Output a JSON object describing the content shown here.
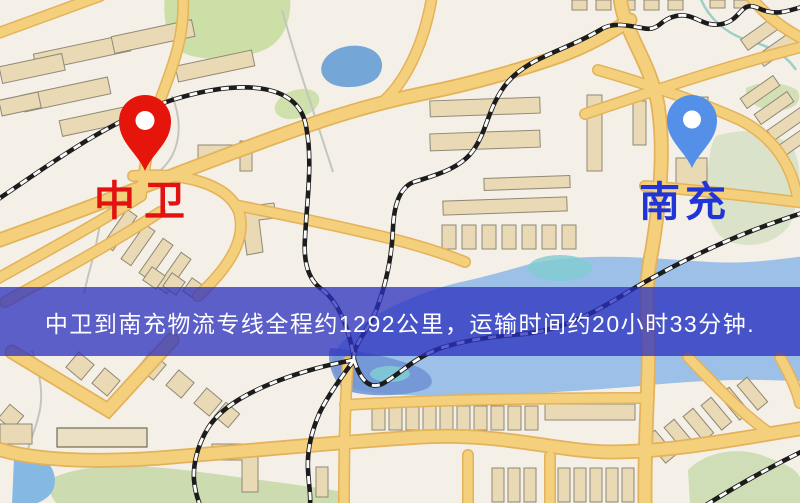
{
  "map": {
    "banner": {
      "text": "中卫到南充物流专线全程约1292公里，运输时间约20小时33分钟.",
      "background": "#2c30be",
      "text_color": "#ffffff"
    },
    "origin": {
      "name": "中卫",
      "label_color": "#e21212",
      "pin_color": "#e6150c",
      "pin_icon": "red-map-pin"
    },
    "destination": {
      "name": "南充",
      "label_color": "#2135d6",
      "pin_color": "#5590e8",
      "pin_icon": "blue-map-pin"
    },
    "route": {
      "distance_km": "1292",
      "duration": "20小时33分钟"
    },
    "colors": {
      "background": "#f5f0e7",
      "road": "#f4d07d",
      "road_casing": "#e3b25a",
      "water": "#9cc0e8",
      "pond": "#74a6d8",
      "park": "#cbdfa6",
      "building": "#e9d9b4",
      "railway": "#1c1c1c"
    }
  }
}
